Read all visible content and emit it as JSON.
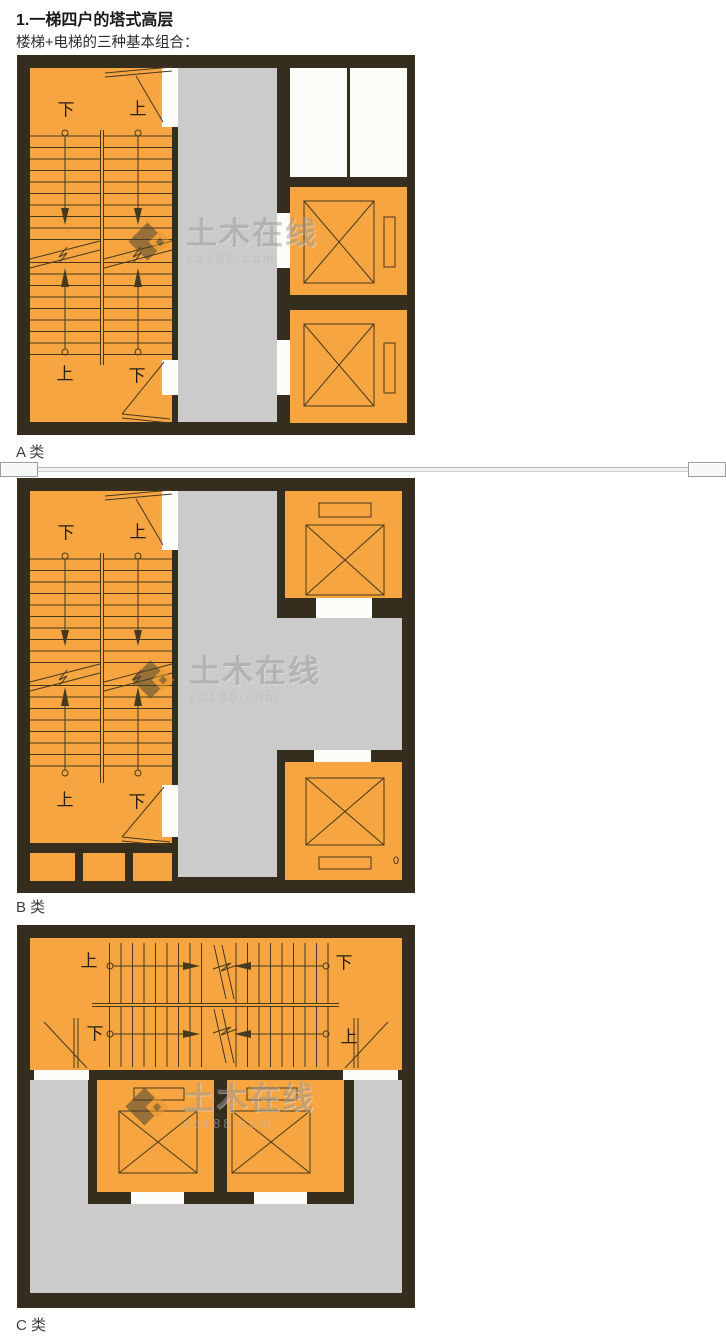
{
  "page": {
    "title": "1.一梯四户的塔式高层",
    "subtitle": "楼梯+电梯的三种基本组合："
  },
  "watermark": {
    "brand": "土木在线",
    "domain": "co188.com"
  },
  "colors": {
    "wall": "#352e1f",
    "room_orange": "#f6a541",
    "corridor_gray": "#cbcbcb",
    "shaft_white": "#fcfcf8",
    "plan_line": "#453a1f",
    "watermark_gray": "#9c9c9c"
  },
  "plans": [
    {
      "caption": "A 类",
      "stair_labels": {
        "top_left": "下",
        "top_right": "上",
        "bottom_left": "上",
        "bottom_right": "下"
      }
    },
    {
      "caption": "B 类",
      "stair_labels": {
        "top_left": "下",
        "top_right": "上",
        "bottom_left": "上",
        "bottom_right": "下"
      },
      "artifact_digit": "0"
    },
    {
      "caption": "C 类",
      "stair_labels": {
        "row1_left": "上",
        "row1_right": "下",
        "row2_left": "下",
        "row2_right": "上"
      }
    }
  ]
}
